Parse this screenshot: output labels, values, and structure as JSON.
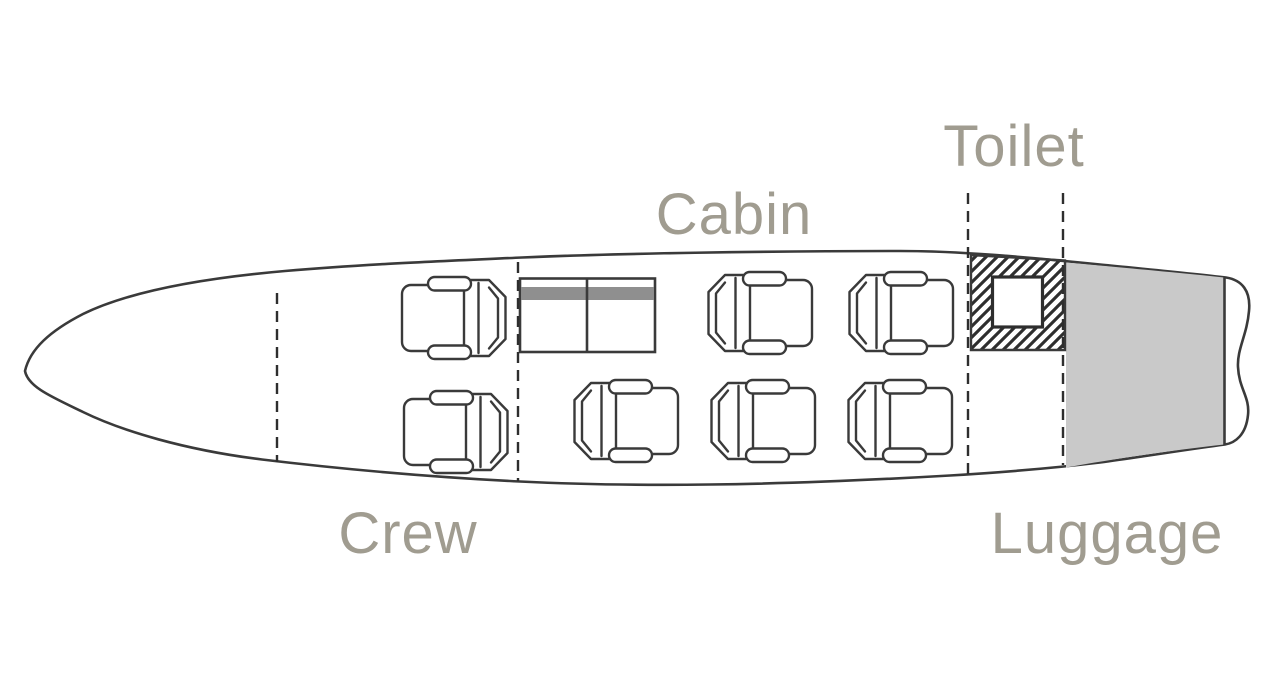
{
  "diagram": {
    "type": "aircraft-cabin-floor-plan",
    "labels": {
      "crew": "Crew",
      "cabin": "Cabin",
      "toilet": "Toilet",
      "luggage": "Luggage"
    },
    "sections": [
      {
        "id": "crew",
        "label": "Crew",
        "seats": 2,
        "features": []
      },
      {
        "id": "cabin",
        "label": "Cabin",
        "seats": 5,
        "features": [
          "table"
        ]
      },
      {
        "id": "toilet",
        "label": "Toilet",
        "seats": 0,
        "features": [
          "toilet-unit"
        ]
      },
      {
        "id": "luggage",
        "label": "Luggage",
        "seats": 0,
        "features": [
          "cargo-area"
        ],
        "shaded": true
      }
    ],
    "total_seats": 7,
    "colors": {
      "background": "#ffffff",
      "outline": "#3a3a3a",
      "label_text": "#a09c90",
      "luggage_fill": "#c9c9c9",
      "table_shelf_fill": "#8f8f8f",
      "hatch_stroke": "#2e2e2e"
    }
  }
}
